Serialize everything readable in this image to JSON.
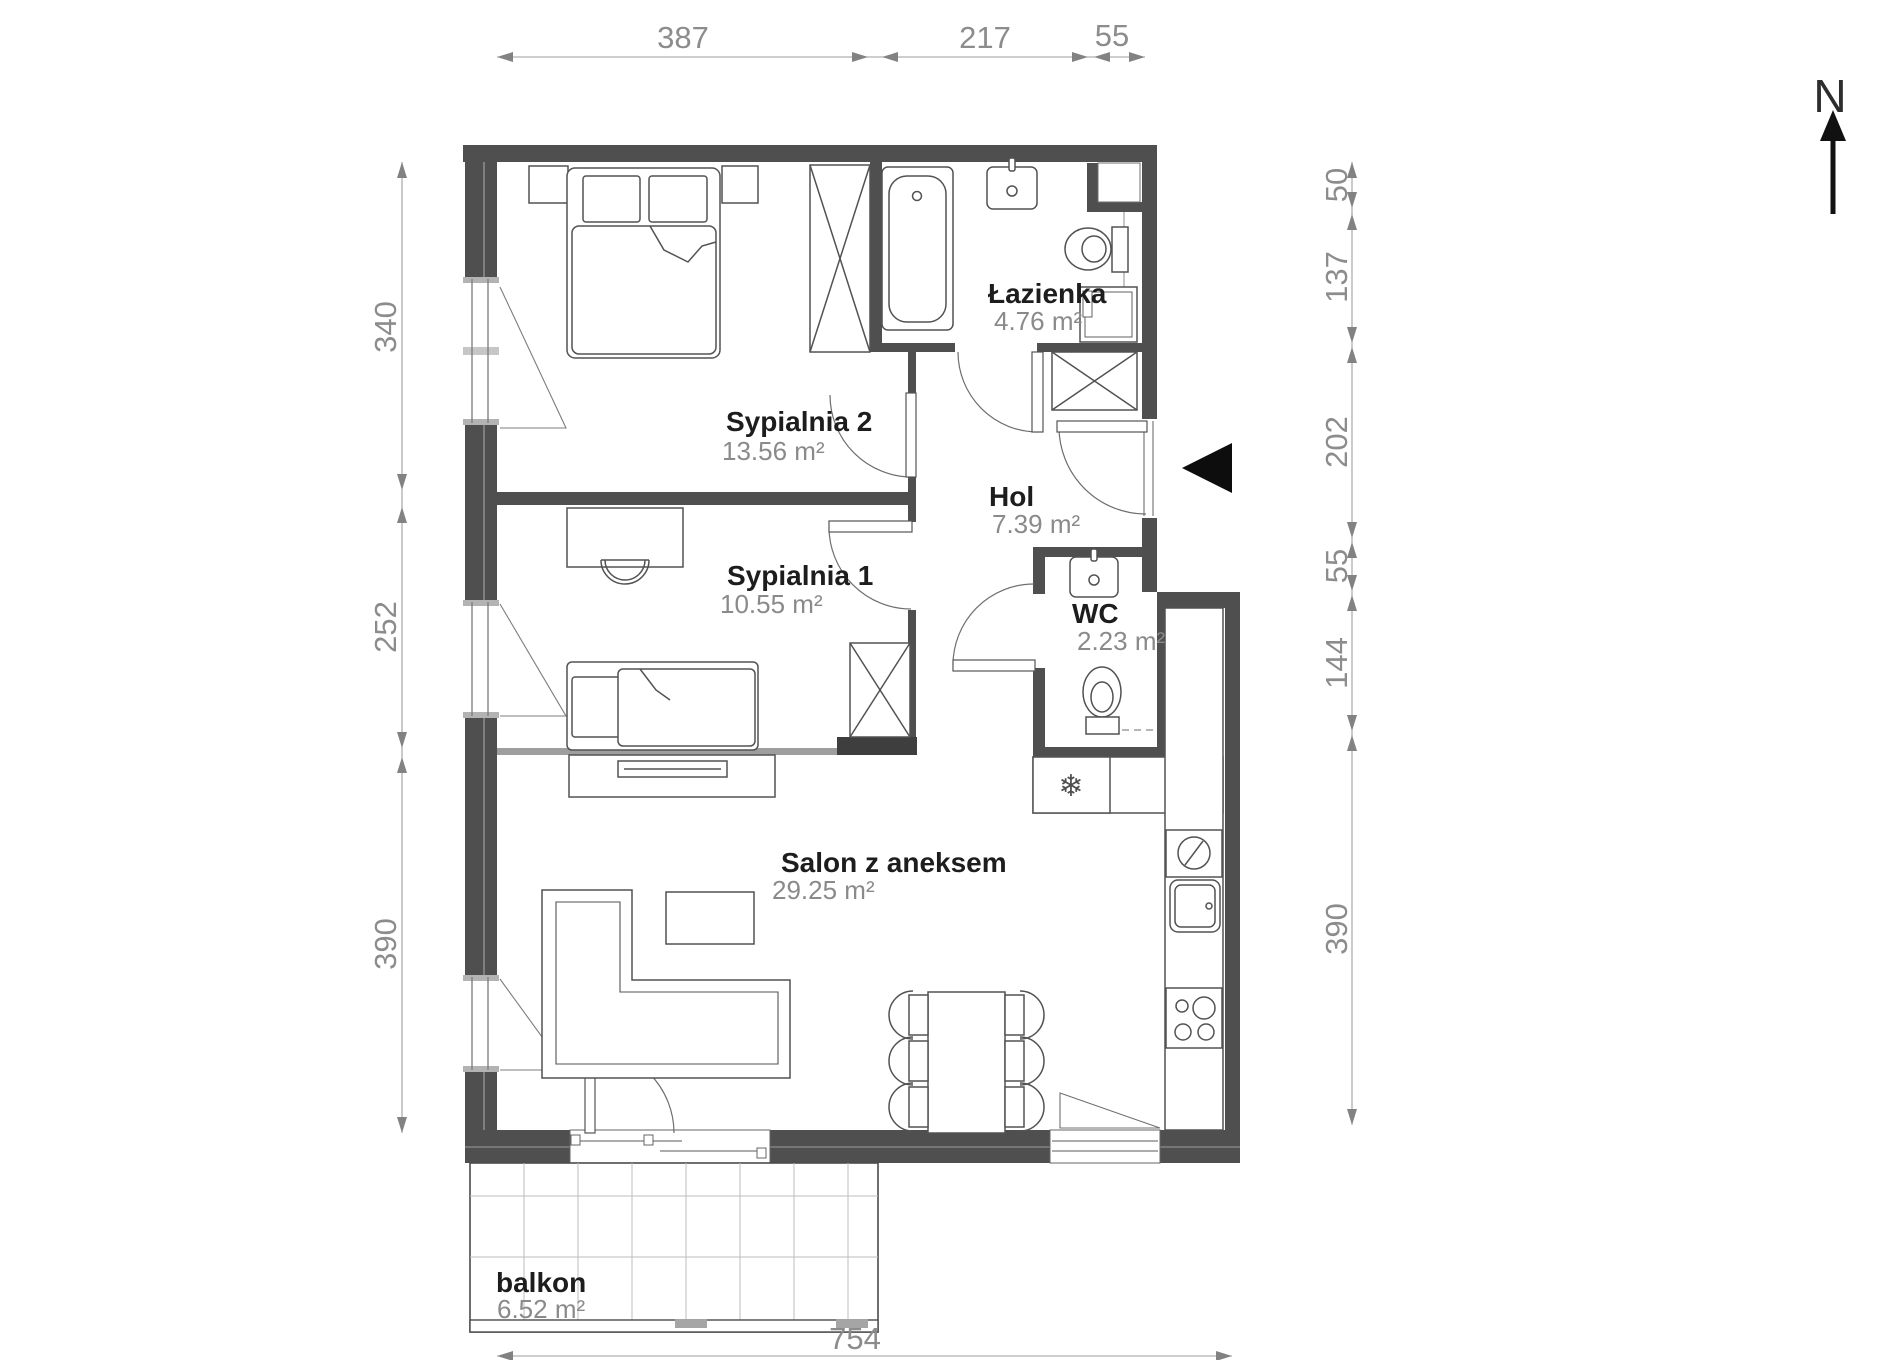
{
  "north": {
    "label": "N"
  },
  "rooms": [
    {
      "id": "sypialnia-2",
      "name": "Sypialnia 2",
      "area": "13.56 m²"
    },
    {
      "id": "sypialnia-1",
      "name": "Sypialnia 1",
      "area": "10.55 m²"
    },
    {
      "id": "lazienka",
      "name": "Łazienka",
      "area": "4.76 m²"
    },
    {
      "id": "hol",
      "name": "Hol",
      "area": "7.39 m²"
    },
    {
      "id": "wc",
      "name": "WC",
      "area": "2.23 m²"
    },
    {
      "id": "salon",
      "name": "Salon z aneksem",
      "area": "29.25 m²"
    },
    {
      "id": "balkon",
      "name": "balkon",
      "area": "6.52 m²"
    }
  ],
  "dimensions": {
    "top": [
      "387",
      "217",
      "55"
    ],
    "left": [
      "340",
      "252",
      "390"
    ],
    "right": [
      "50",
      "137",
      "202",
      "55",
      "144",
      "390"
    ],
    "bottom": [
      "754"
    ]
  },
  "icons": {
    "fridge": "❄"
  },
  "colors": {
    "wall": "#4f4f4f",
    "wall_light": "#9e9e9e",
    "furniture_line": "#525252",
    "dimension_line": "#9e9e9e",
    "dimension_text": "#8c8c8c",
    "room_name_text": "#1d1d1d",
    "room_area_text": "#8a8a8a",
    "entrance_marker": "#0d0d0d"
  }
}
